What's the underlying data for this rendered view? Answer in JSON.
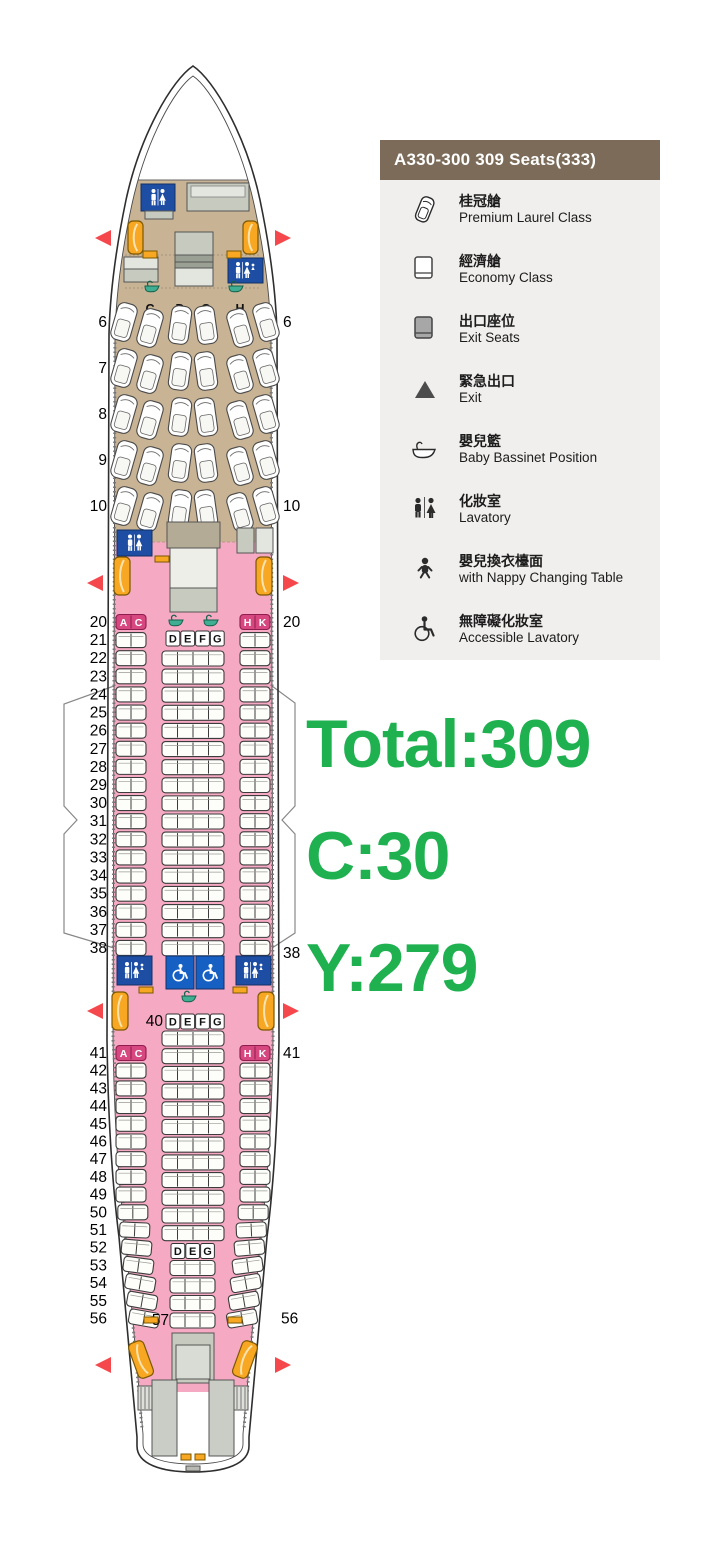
{
  "legend": {
    "header": "A330-300 309 Seats(333)",
    "items": [
      {
        "icon": "premium-seat-icon",
        "zh": "桂冠艙",
        "en": "Premium Laurel Class"
      },
      {
        "icon": "economy-seat-icon",
        "zh": "經濟艙",
        "en": "Economy Class"
      },
      {
        "icon": "exit-seat-icon",
        "zh": "出口座位",
        "en": "Exit Seats"
      },
      {
        "icon": "exit-triangle-icon",
        "zh": "緊急出口",
        "en": "Exit"
      },
      {
        "icon": "bassinet-icon",
        "zh": "嬰兒籃",
        "en": "Baby Bassinet Position"
      },
      {
        "icon": "lavatory-icon",
        "zh": "化妝室",
        "en": "Lavatory"
      },
      {
        "icon": "nappy-icon",
        "zh": "嬰兒換衣檯面",
        "en": "with Nappy Changing Table"
      },
      {
        "icon": "accessible-icon",
        "zh": "無障礙化妝室",
        "en": "Accessible Lavatory"
      }
    ]
  },
  "summary": {
    "total": "Total:309",
    "business": "C:30",
    "economy": "Y:279"
  },
  "colors": {
    "green": "#1fb150",
    "brown": "#7b6b58",
    "panel": "#f1efed",
    "pink": "#f5a9c3",
    "tan": "#c8b395",
    "magenta": "#d6487f",
    "magentaDark": "#8f1c4e",
    "lavBlue": "#1e4ea3",
    "accessibleBlue": "#1560c2",
    "doorOrange": "#f7a722",
    "doorEdge": "#7c5800",
    "triangleRed": "#f4484c",
    "bassinetTeal": "#3fae92",
    "bassinetDark": "#15604b",
    "galley": "#c6cabf",
    "galleyLight": "#e3e5df",
    "outline": "#2e2e2e"
  },
  "seatmap": {
    "business": {
      "header_letters": [
        "A",
        "C",
        "D",
        "G",
        "H",
        "K"
      ],
      "rows": [
        6,
        7,
        8,
        9,
        10
      ],
      "right_labeled_rows": [
        6,
        10
      ]
    },
    "economy_front": {
      "side_rows": [
        20,
        21,
        22,
        23,
        24,
        25,
        26,
        27,
        28,
        29,
        30,
        31,
        32,
        33,
        34,
        35,
        36,
        37,
        38
      ],
      "magenta_rows": [
        20
      ],
      "left_letters": [
        "A",
        "C"
      ],
      "right_letters": [
        "H",
        "K"
      ],
      "center_letters": [
        "D",
        "E",
        "F",
        "G"
      ],
      "center_row_count": 17,
      "right_labeled_rows": [
        20,
        38
      ]
    },
    "economy_rear": {
      "center_header_label": "40",
      "center_letters": [
        "D",
        "E",
        "F",
        "G"
      ],
      "center4_row_count": 12,
      "side_rows": [
        41,
        42,
        43,
        44,
        45,
        46,
        47,
        48,
        49,
        50,
        51,
        52,
        53,
        54,
        55,
        56
      ],
      "magenta_rows": [
        41
      ],
      "left_letters": [
        "A",
        "C"
      ],
      "right_letters": [
        "H",
        "K"
      ],
      "center3_letters": [
        "D",
        "E",
        "G"
      ],
      "center3_row_count": 4,
      "last_center_label": "57",
      "right_labeled_rows": [
        41,
        56
      ]
    }
  }
}
